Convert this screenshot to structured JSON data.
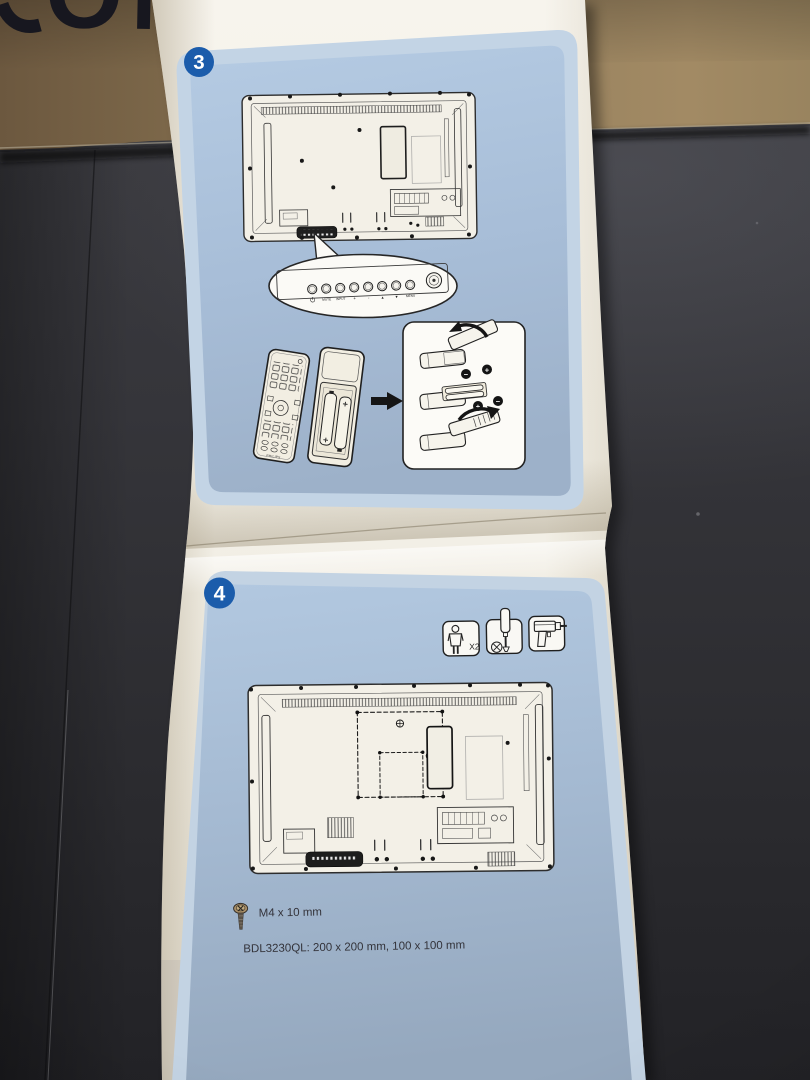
{
  "box": {
    "partial_text": "ON"
  },
  "leaflet": {
    "step3": {
      "number": "3",
      "controls": {
        "labels": [
          "MUTE",
          "INPUT",
          "+",
          "-",
          "▲",
          "▼",
          "MENU"
        ]
      },
      "remote": {
        "brand": "PHILIPS"
      },
      "battery_signs": [
        "−",
        "+",
        "+",
        "−"
      ]
    },
    "step4": {
      "number": "4",
      "people_label": "X2",
      "screw_spec": "M4 x 10 mm",
      "mount_spec": "BDL3230QL: 200 x 200 mm, 100 x 100 mm"
    }
  },
  "colors": {
    "badge_blue": "#1b5cab",
    "panel_blue": "#a9bfd8",
    "panel_edge_blue": "#c3d4e5",
    "paper": "#f4f1e9",
    "cardboard": "#8d7554",
    "table": "#333338",
    "line_art": "#2d2d2d"
  },
  "icons": [
    "person-icon",
    "screwdriver-icon",
    "drill-icon",
    "screw-icon",
    "power-icon",
    "ir-sensor-icon",
    "arrow-right-icon",
    "rotate-arrow-icon",
    "battery-icon"
  ]
}
